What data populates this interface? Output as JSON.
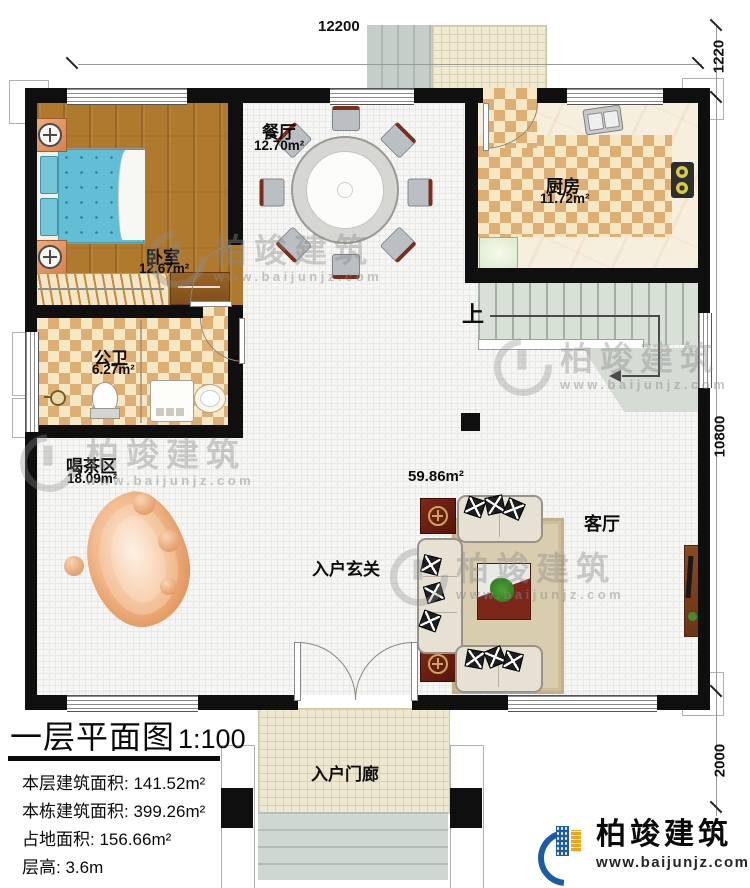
{
  "plan": {
    "title": "一层平面图",
    "scale": "1:100",
    "info": [
      {
        "label": "本层建筑面积:",
        "value": "141.52m²"
      },
      {
        "label": "本栋建筑面积:",
        "value": "399.26m²"
      },
      {
        "label": "占地面积:",
        "value": "156.66m²"
      },
      {
        "label": "层高:",
        "value": "3.6m"
      }
    ]
  },
  "dimensions": {
    "top": "12200",
    "right_top": "1220",
    "right_mid": "10800",
    "right_bottom": "2000"
  },
  "rooms": {
    "dining": {
      "name": "餐厅",
      "area": "12.70m²"
    },
    "kitchen": {
      "name": "厨房",
      "area": "11.72m²"
    },
    "bedroom": {
      "name": "卧室",
      "area": "12.67m²"
    },
    "bath": {
      "name": "公卫",
      "area": "6.27m²"
    },
    "tea": {
      "name": "喝茶区",
      "area": "18.09m²"
    },
    "living": {
      "name": "客厅",
      "area": "59.86m²"
    },
    "foyer": {
      "name": "入户玄关"
    },
    "porch": {
      "name": "入户门廊"
    },
    "stair_up": {
      "name": "上"
    }
  },
  "brand": {
    "name": "柏竣建筑",
    "url": "www.baijunjz.com"
  },
  "watermark": {
    "name": "柏竣建筑",
    "url": "www.baijunjz.com"
  },
  "colors": {
    "wall": "#0f0f0f",
    "brand_blue": "#1a5cab",
    "brand_orange": "#f2a21f",
    "wood_floor": "#b07a2e",
    "checker_tan": "#dfae72",
    "stair_gray": "#d9e0d8"
  }
}
